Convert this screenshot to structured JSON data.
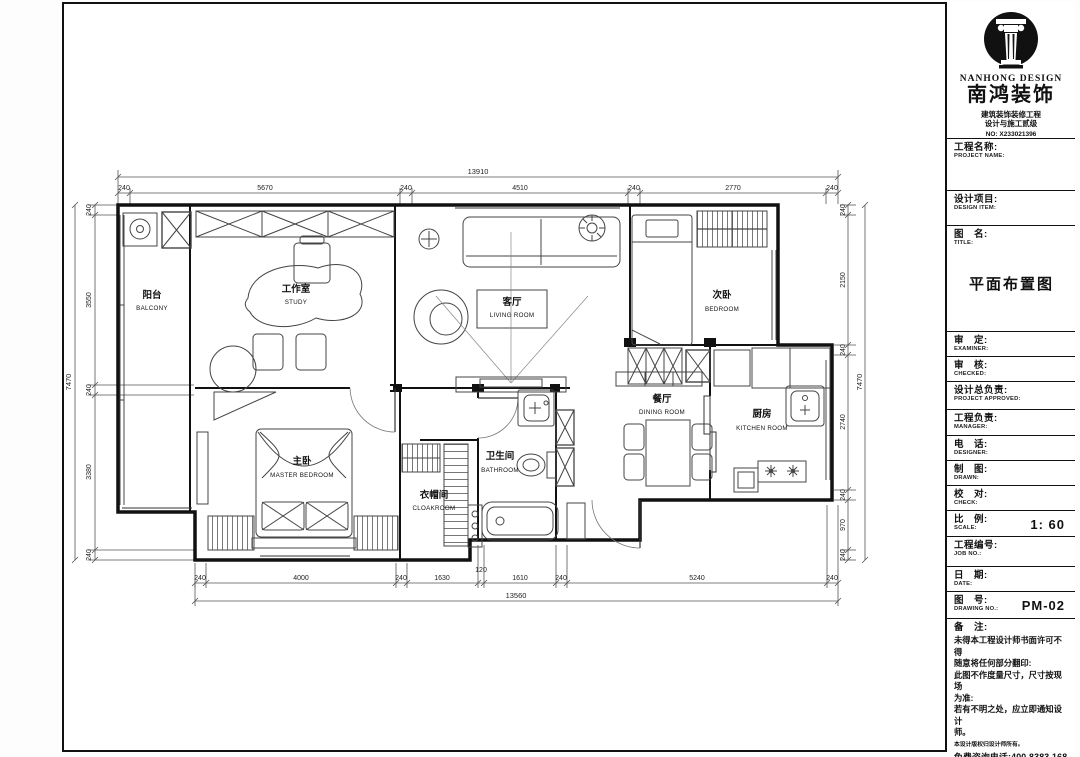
{
  "company": {
    "en_name": "NANHONG DESIGN",
    "cn_name": "南鸿装饰",
    "cert_line1": "建筑装饰装修工程",
    "cert_line2": "设计与施工贰级",
    "cert_no": "NO: X233021396"
  },
  "sidebar": {
    "fields": [
      {
        "cn": "工程名称:",
        "en": "PROJECT NAME:",
        "value": ""
      },
      {
        "cn": "设计项目:",
        "en": "DESIGN ITEM:",
        "value": ""
      },
      {
        "cn": "图　名:",
        "en": "TITLE:",
        "value": "平面布置图"
      },
      {
        "cn": "审　定:",
        "en": "EXAMINER:",
        "value": ""
      },
      {
        "cn": "审　核:",
        "en": "CHECKED:",
        "value": ""
      },
      {
        "cn": "设计总负责:",
        "en": "PROJECT APPROVED:",
        "value": ""
      },
      {
        "cn": "工程负责:",
        "en": "MANAGER:",
        "value": ""
      },
      {
        "cn": "电　话:",
        "en": "DESIGNER:",
        "value": ""
      },
      {
        "cn": "制　图:",
        "en": "DRAWN:",
        "value": ""
      },
      {
        "cn": "校　对:",
        "en": "CHECK:",
        "value": ""
      },
      {
        "cn": "比　例:",
        "en": "SCALE:",
        "value": "1: 60"
      },
      {
        "cn": "工程编号:",
        "en": "JOB NO.:",
        "value": ""
      },
      {
        "cn": "日　期:",
        "en": "DATE:",
        "value": ""
      },
      {
        "cn": "图　号:",
        "en": "DRAWING NO.:",
        "value": "PM-02"
      }
    ],
    "notes": {
      "heading": "备　注:",
      "line1": "未得本工程设计师书面许可不得",
      "line2": "随意将任何部分翻印:",
      "line3": "此图不作度量尺寸，尺寸按现场",
      "line4": "为准:",
      "line5": "若有不明之处，应立即通知设计",
      "line6": "师。",
      "fine_print": "本设计版权归设计师所有。",
      "hotline": "免费咨询电话:400 8383 168"
    }
  },
  "plan": {
    "rooms": [
      {
        "cn": "阳台",
        "en": "BALCONY"
      },
      {
        "cn": "工作室",
        "en": "STUDY"
      },
      {
        "cn": "客厅",
        "en": "LIVING ROOM"
      },
      {
        "cn": "次卧",
        "en": "BEDROOM"
      },
      {
        "cn": "餐厅",
        "en": "DINING ROOM"
      },
      {
        "cn": "厨房",
        "en": "KITCHEN ROOM"
      },
      {
        "cn": "主卧",
        "en": "MASTER BEDROOM"
      },
      {
        "cn": "卫生间",
        "en": "BATHROOM"
      },
      {
        "cn": "衣帽间",
        "en": "CLOAKROOM"
      }
    ],
    "dims": {
      "top": {
        "total": "13910",
        "segs": [
          "240",
          "5670",
          "240",
          "4510",
          "240",
          "2770",
          "240"
        ]
      },
      "bottom": {
        "total": "13560",
        "segs": [
          "240",
          "4000",
          "240",
          "1630",
          "120",
          "1610",
          "240",
          "5240",
          "240"
        ]
      },
      "left": {
        "total": "7470",
        "segs": [
          "240",
          "3550",
          "240",
          "3380",
          "240"
        ]
      },
      "right": {
        "total": "7470",
        "segs": [
          "240",
          "2150",
          "240",
          "2740",
          "240",
          "970",
          "240"
        ]
      }
    }
  }
}
